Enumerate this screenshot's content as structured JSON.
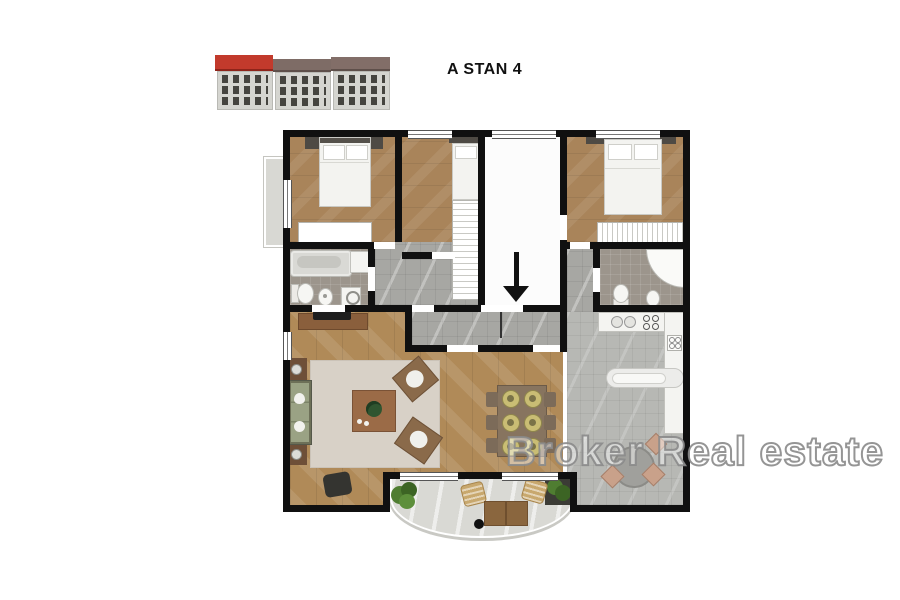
{
  "header": {
    "title": "A STAN 4"
  },
  "watermark": {
    "text": "Broker Real estate"
  },
  "building_thumbnail": {
    "description_icon": "residential-building-elevation",
    "highlighted_roof_color": "#c23a2c",
    "roof_color": "#7e6c66",
    "facade_color": "#d5d5d0"
  },
  "floor_plan": {
    "entrance_arrow_icon": "down-arrow",
    "colors": {
      "wall": "#101010",
      "wood_floor": "#b08a58",
      "bathroom_tile": "#9c958c",
      "hallway_tile": "#a7a7a3",
      "kitchen_tile": "#b7b8b4",
      "entry_floor": "#fcfcfc",
      "balcony_floor": "#d9d9d4",
      "rug": "#d8d1c7",
      "sofa": "#9aa284",
      "dining_table": "#87745f"
    }
  }
}
